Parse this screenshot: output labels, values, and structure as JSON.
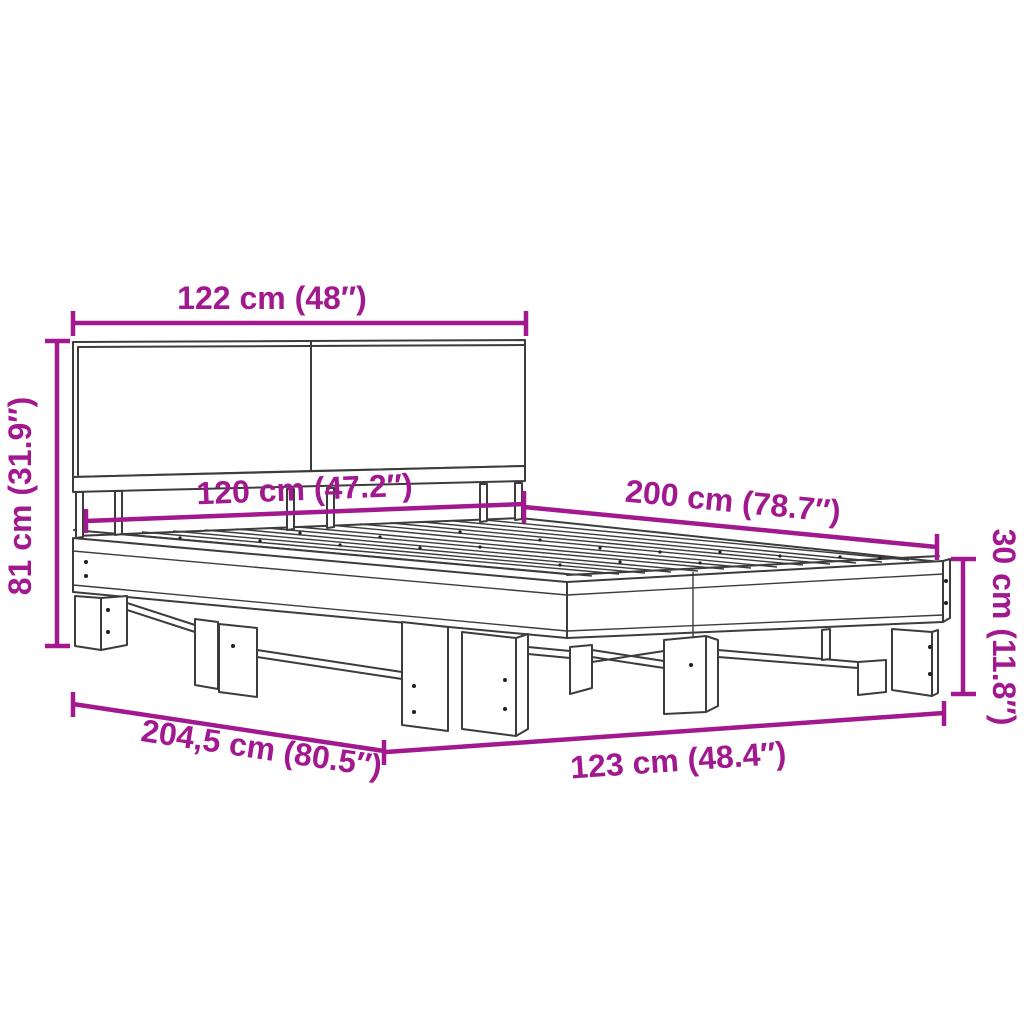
{
  "figure": {
    "type": "product-dimension-diagram",
    "subject": "bed-frame-with-headboard",
    "background_color": "#ffffff",
    "dimension_color": "#A1188F",
    "drawing_line_color": "#3C3C3C"
  },
  "dimensions": {
    "headboard_width": "122 cm (48″)",
    "headboard_height": "81 cm (31.9″)",
    "inner_width": "120 cm (47.2″)",
    "bed_length": "200 cm (78.7″)",
    "frame_height": "30 cm (11.8″)",
    "total_length": "204,5 cm (80.5″)",
    "total_width": "123 cm (48.4″)"
  }
}
